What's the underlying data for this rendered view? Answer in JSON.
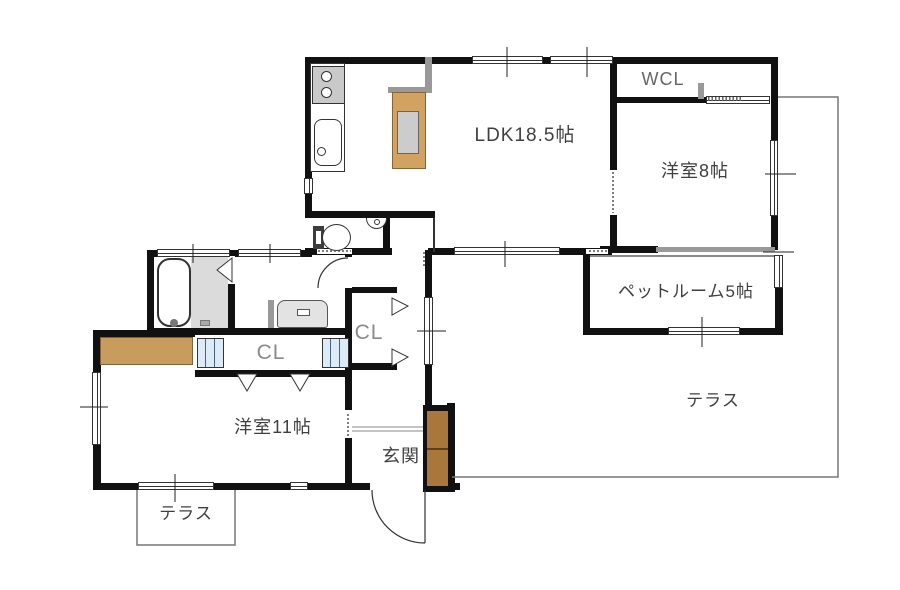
{
  "floorplan": {
    "type": "residential-floor-plan",
    "rooms": {
      "ldk": {
        "label": "LDK18.5帖"
      },
      "wcl": {
        "label": "WCL"
      },
      "west_room_8": {
        "label": "洋室8帖"
      },
      "pet_room": {
        "label": "ペットルーム5帖"
      },
      "terrace_right": {
        "label": "テラス"
      },
      "closet_main": {
        "label": "CL"
      },
      "closet_hall": {
        "label": "CL"
      },
      "west_room_11": {
        "label": "洋室11帖"
      },
      "entrance": {
        "label": "玄関"
      },
      "terrace_left": {
        "label": "テラス"
      }
    },
    "colors": {
      "wall": "#111111",
      "partition_gray": "#999999",
      "slider_gray": "#9a9a9a",
      "island_counter_wood": "#D2A262",
      "shoe_cabinet_wood": "#A9763C",
      "closet_counter_wood": "#C79C5D",
      "closet_door_blue": "#DDEBF8",
      "fixture_gray": "#DBDBDB",
      "label_text": "#3f3f3f",
      "closet_text": "#8a8a8a",
      "terrace_line": "#777777"
    }
  }
}
